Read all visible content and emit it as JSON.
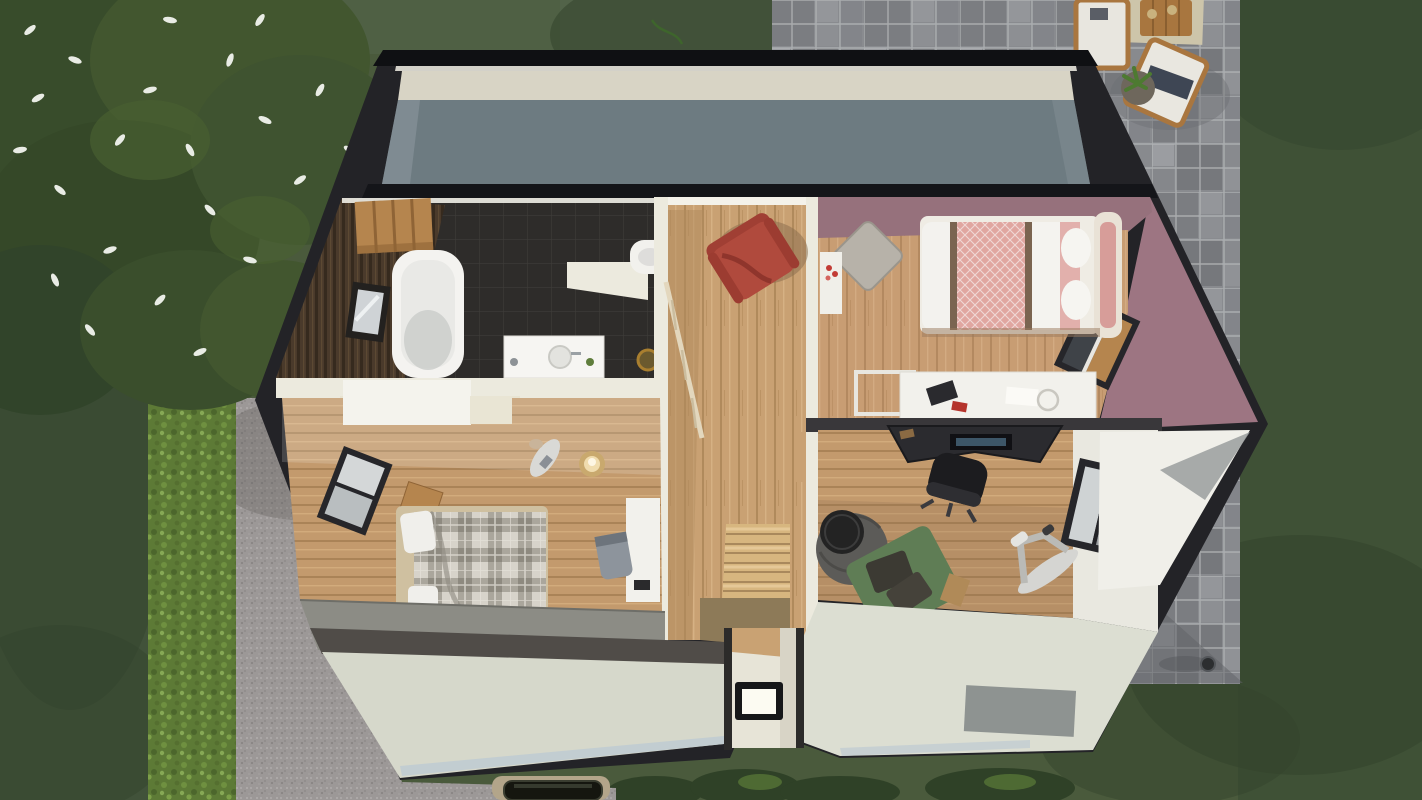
{
  "scene": {
    "type": "3d-floorplan-top-view",
    "areas": [
      {
        "name": "garden-lawn"
      },
      {
        "name": "hedge"
      },
      {
        "name": "flowering-tree"
      },
      {
        "name": "paved-terrace"
      },
      {
        "name": "gravel-driveway"
      },
      {
        "name": "house-upper-floor-cutaway"
      },
      {
        "name": "bathroom"
      },
      {
        "name": "landing-hallway"
      },
      {
        "name": "staircase"
      },
      {
        "name": "bedroom-pink"
      },
      {
        "name": "bedroom-plaid"
      },
      {
        "name": "office-gym"
      },
      {
        "name": "attic-roof-slope"
      },
      {
        "name": "front-facade"
      }
    ]
  },
  "palette": {
    "grass_base": "#4a5a3c",
    "grass_left": "#41523a",
    "grass_right": "#3f5136",
    "grass_light": "#53644a",
    "grass_shadow": "#33432c",
    "canopy": "#384c2b",
    "canopy2": "#42562f",
    "flower_white": "#e9ece5",
    "hedge_green": "#5d7a36",
    "terrace_gray": "#898b8f",
    "gravel_gray": "#9c9897",
    "curb_white": "#eae9e4",
    "outer_wall": "#232327",
    "top_band": "#0f1013",
    "attic_cream": "#d8d4c5",
    "attic_slope": "#6d7b81",
    "separator": "#141519",
    "wall_white": "#eceade",
    "wall_cream": "#e8e4d2",
    "bath_tile": "#2e2c2a",
    "bath_wood": "#4a3a2b",
    "oak": "#b5854e",
    "tub_white": "#f4f3f0",
    "wood_floor": "#c9a173",
    "wood_shade": "#b08a5c",
    "armchair_red": "#b04a3d",
    "mauve_wall": "#9d7582",
    "mauve_dark": "#96717c",
    "quilt_pink": "#e0a6a0",
    "bed_frame": "#cfc0a0",
    "desk_white": "#f2f1ec",
    "office_sep": "#39373a",
    "desk_black": "#2b2b2f",
    "chair_black": "#1c1c1f",
    "pouf_gray": "#5c5b58",
    "daybed_green": "#5f7d55",
    "bike_gray": "#d5d5d2",
    "facade_cream": "#d6d8cb",
    "facade_right": "#dcded2",
    "roof_dark": "#504c48",
    "strip_blue": "#c0ccd1",
    "skylight_frame": "#161719",
    "skylight_glass": "#fcfbf2",
    "window_frame": "#26262a",
    "gable_white": "#f0efe9",
    "blanket_navy": "#3e4654",
    "car_black": "#15160f",
    "car_pad": "#b3a58a",
    "lamp_glow": "#f0dcae"
  }
}
